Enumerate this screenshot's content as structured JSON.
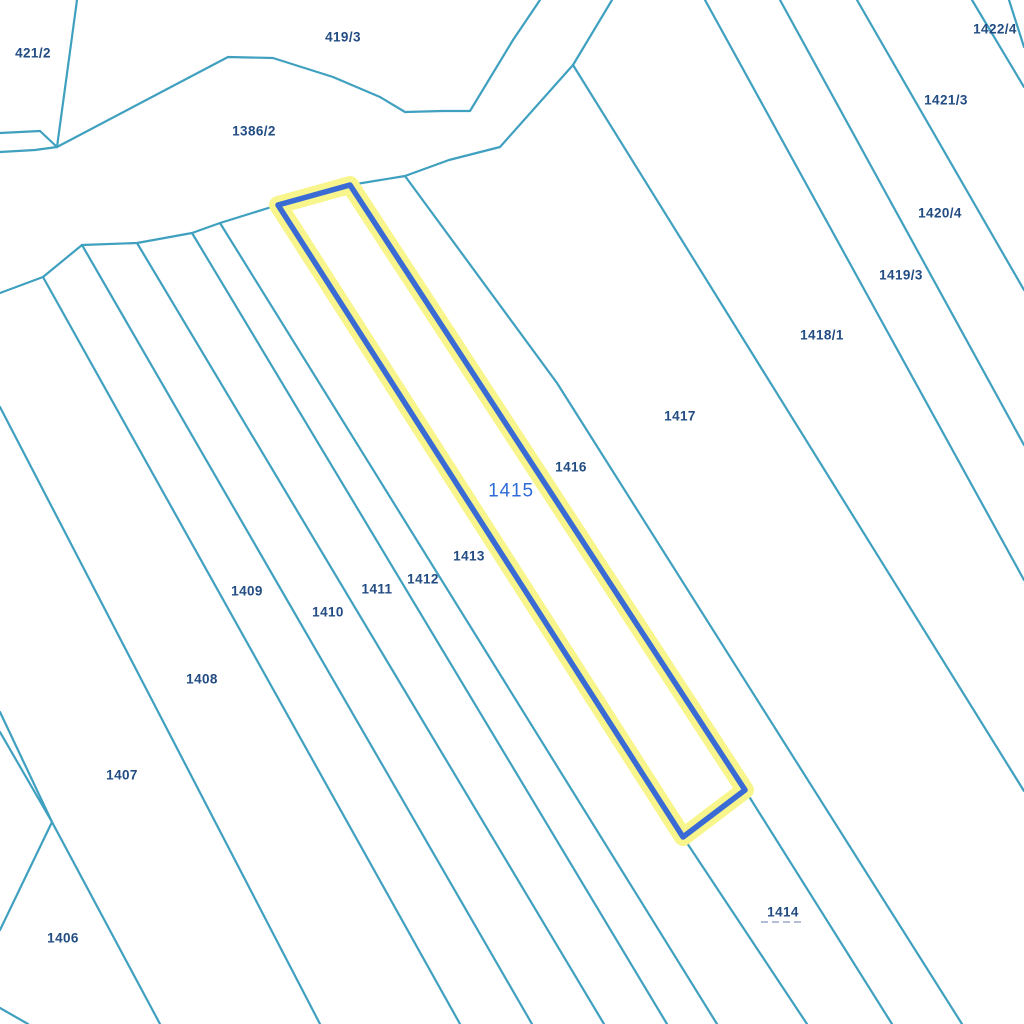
{
  "map": {
    "background_color": "#ffffff",
    "line_color": "#3fa0bf",
    "line_width": 2.2,
    "label_color": "#224c82",
    "selected_label_color": "#2f6bd9",
    "underline_color": "#9aa9c9",
    "highlight": {
      "halo_color": "#f7f58c",
      "halo_width": 18,
      "stroke_color": "#3a6bd5",
      "stroke_width": 5.5,
      "parcel": "1415",
      "points": [
        [
          278,
          205
        ],
        [
          350,
          185
        ],
        [
          745,
          790
        ],
        [
          683,
          837
        ]
      ]
    },
    "boundary_lines": [
      {
        "name": "ridge-north-of-strips",
        "points": [
          [
            0,
            293
          ],
          [
            43,
            277
          ],
          [
            82,
            245
          ],
          [
            137,
            243
          ],
          [
            192,
            233
          ],
          [
            220,
            223
          ],
          [
            278,
            205
          ],
          [
            350,
            185
          ],
          [
            405,
            176
          ],
          [
            449,
            160
          ],
          [
            500,
            147
          ],
          [
            573,
            65
          ]
        ]
      },
      {
        "name": "parcel-1386-2-south-boundary",
        "points": [
          [
            0,
            152
          ],
          [
            35,
            150
          ],
          [
            57,
            147
          ],
          [
            228,
            57
          ],
          [
            273,
            58
          ],
          [
            333,
            77
          ],
          [
            380,
            97
          ],
          [
            405,
            112
          ],
          [
            443,
            111
          ],
          [
            470,
            111
          ],
          [
            513,
            40
          ],
          [
            540,
            0
          ]
        ]
      },
      {
        "name": "sliver-west",
        "points": [
          [
            0,
            133
          ],
          [
            40,
            131
          ],
          [
            57,
            147
          ]
        ]
      },
      {
        "name": "boundary-421-2-east",
        "points": [
          [
            77,
            0
          ],
          [
            57,
            147
          ]
        ]
      },
      {
        "name": "strip-west-of-1407",
        "points": [
          [
            0,
            407
          ],
          [
            320,
            1024
          ]
        ]
      },
      {
        "name": "strip-1408-1409",
        "points": [
          [
            43,
            277
          ],
          [
            460,
            1024
          ]
        ]
      },
      {
        "name": "strip-1409-1410",
        "points": [
          [
            82,
            245
          ],
          [
            532,
            1024
          ]
        ]
      },
      {
        "name": "strip-1410-1411",
        "points": [
          [
            137,
            243
          ],
          [
            604,
            1024
          ]
        ]
      },
      {
        "name": "strip-1411-1412",
        "points": [
          [
            192,
            233
          ],
          [
            667,
            1024
          ]
        ]
      },
      {
        "name": "strip-1412-1413",
        "points": [
          [
            220,
            223
          ],
          [
            717,
            1024
          ]
        ]
      },
      {
        "name": "strip-1413-ext-below-highlight",
        "points": [
          [
            683,
            837
          ],
          [
            807,
            1024
          ]
        ]
      },
      {
        "name": "strip-1414-east-ext",
        "points": [
          [
            745,
            790
          ],
          [
            892,
            1024
          ]
        ]
      },
      {
        "name": "strip-1416-1417",
        "points": [
          [
            405,
            176
          ],
          [
            557,
            383
          ],
          [
            962,
            1024
          ]
        ]
      },
      {
        "name": "junction-north-leg",
        "points": [
          [
            573,
            65
          ],
          [
            612,
            0
          ]
        ]
      },
      {
        "name": "strip-1417-1418",
        "points": [
          [
            573,
            65
          ],
          [
            1024,
            791
          ]
        ]
      },
      {
        "name": "strip-1418-1419",
        "points": [
          [
            705,
            0
          ],
          [
            1024,
            580
          ]
        ]
      },
      {
        "name": "strip-1419-1420",
        "points": [
          [
            780,
            0
          ],
          [
            1024,
            445
          ]
        ]
      },
      {
        "name": "strip-1420-1421",
        "points": [
          [
            857,
            0
          ],
          [
            1024,
            290
          ]
        ]
      },
      {
        "name": "strip-1421-1422",
        "points": [
          [
            972,
            0
          ],
          [
            1024,
            87
          ]
        ]
      },
      {
        "name": "corner-northeast",
        "points": [
          [
            1009,
            0
          ],
          [
            1024,
            47
          ]
        ]
      },
      {
        "name": "southwest-long",
        "points": [
          [
            0,
            712
          ],
          [
            52,
            822
          ],
          [
            160,
            1024
          ]
        ]
      },
      {
        "name": "southwest-wedge",
        "points": [
          [
            0,
            732
          ],
          [
            52,
            822
          ],
          [
            0,
            930
          ]
        ]
      },
      {
        "name": "corner-southwest",
        "points": [
          [
            0,
            1008
          ],
          [
            28,
            1024
          ]
        ]
      }
    ],
    "labels": [
      {
        "text": "421/2",
        "x": 33,
        "y": 53
      },
      {
        "text": "419/3",
        "x": 343,
        "y": 37
      },
      {
        "text": "1386/2",
        "x": 254,
        "y": 131
      },
      {
        "text": "1422/4",
        "x": 995,
        "y": 29
      },
      {
        "text": "1421/3",
        "x": 946,
        "y": 100
      },
      {
        "text": "1420/4",
        "x": 940,
        "y": 213
      },
      {
        "text": "1419/3",
        "x": 901,
        "y": 275
      },
      {
        "text": "1418/1",
        "x": 822,
        "y": 335
      },
      {
        "text": "1417",
        "x": 680,
        "y": 416
      },
      {
        "text": "1416",
        "x": 571,
        "y": 467
      },
      {
        "text": "1415",
        "x": 511,
        "y": 490,
        "selected": true
      },
      {
        "text": "1413",
        "x": 469,
        "y": 556
      },
      {
        "text": "1412",
        "x": 423,
        "y": 579
      },
      {
        "text": "1411",
        "x": 377,
        "y": 589
      },
      {
        "text": "1410",
        "x": 328,
        "y": 612
      },
      {
        "text": "1409",
        "x": 247,
        "y": 591
      },
      {
        "text": "1408",
        "x": 202,
        "y": 679
      },
      {
        "text": "1407",
        "x": 122,
        "y": 775
      },
      {
        "text": "1406",
        "x": 63,
        "y": 938
      },
      {
        "text": "1414",
        "x": 783,
        "y": 912,
        "underline": "dashed"
      }
    ]
  }
}
